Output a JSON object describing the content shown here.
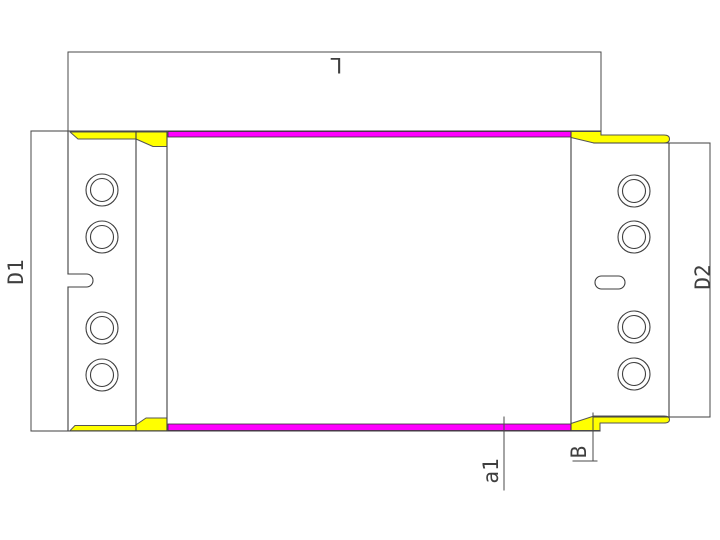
{
  "drawing": {
    "type": "cad-technical-drawing",
    "labels": {
      "overall_length": "L",
      "left_flange_height": "D1",
      "right_flange_height": "D2",
      "surface_layer": "a1",
      "edge_offset": "B"
    },
    "colors": {
      "surface_strip": "#FF00FF",
      "weld_bead": "#FFFF00",
      "line": "#3f3f3f",
      "background": "#FFFFFF"
    },
    "features": {
      "left_flange_hole_count": "4",
      "right_flange_hole_count": "4"
    }
  }
}
